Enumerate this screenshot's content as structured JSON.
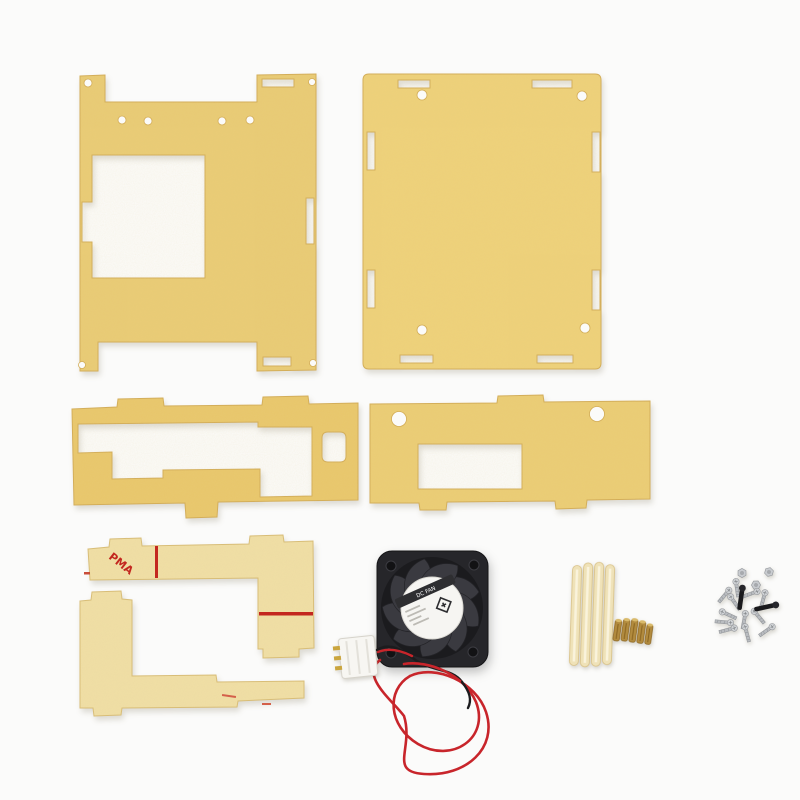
{
  "image": {
    "type": "product-photo",
    "subject": "Clear acrylic case kit (protective film on) with 40mm DC cooling fan, standoff rods, brass spacers and screws on white background",
    "background_color": "#fbfbfa"
  },
  "markings": {
    "film_print": "PMA",
    "marking_color": "#c32222"
  },
  "fan": {
    "label": "DC FAN",
    "body_color": "#26262a",
    "hub_label_color": "#f6f5f2",
    "wire_red": "#c8252b",
    "wire_black": "#1c1c1e",
    "connector_color": "#f7f6f2",
    "pin_count": 3
  },
  "hardware": {
    "standoff_rod_count": 4,
    "standoff_color": "#efe2b8",
    "brass_spacer_count": 5,
    "brass_color": "#b28b3e",
    "screw_color": "#c0c3c6",
    "black_screw_count": 2,
    "nut_count": 3
  },
  "parts": [
    {
      "name": "front-panel-display-cutout",
      "color": "#e9cb74"
    },
    {
      "name": "back-panel",
      "color": "#eed179"
    },
    {
      "name": "port-side-panel",
      "color": "#e9c76b"
    },
    {
      "name": "side-panel-b",
      "color": "#ebcd74"
    },
    {
      "name": "corner-bracket-a",
      "color": "#f0dfa6"
    },
    {
      "name": "corner-bracket-b",
      "color": "#f0dfa6"
    },
    {
      "name": "cooling-fan-40mm",
      "color": "#26262a"
    },
    {
      "name": "standoff-rods",
      "color": "#efe2b8"
    },
    {
      "name": "brass-spacers",
      "color": "#b28b3e"
    },
    {
      "name": "screws-and-nuts",
      "color": "#c0c3c6"
    }
  ]
}
